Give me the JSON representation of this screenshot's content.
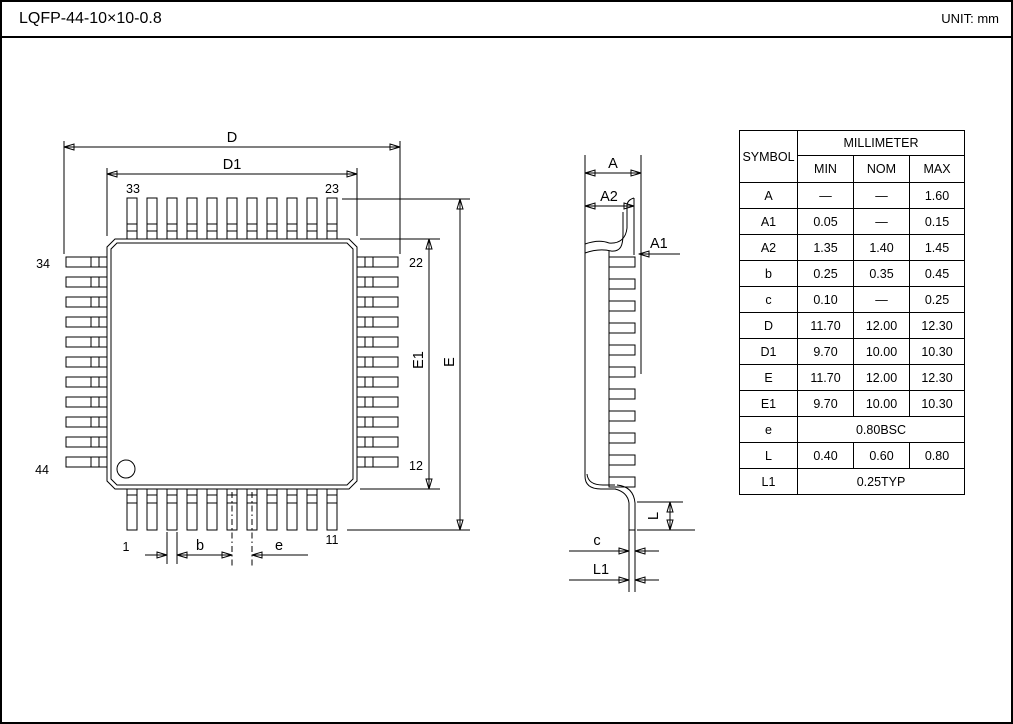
{
  "page": {
    "title": "LQFP-44-10×10-0.8",
    "unit_label": "UNIT: mm"
  },
  "top_view": {
    "dim_labels": {
      "D": "D",
      "D1": "D1",
      "E": "E",
      "E1": "E1",
      "b": "b",
      "e": "e"
    },
    "pin_numbers": {
      "p33": "33",
      "p23": "23",
      "p34": "34",
      "p44": "44",
      "p22": "22",
      "p12": "12",
      "p1": "1",
      "p11": "11"
    }
  },
  "side_view": {
    "dim_labels": {
      "A": "A",
      "A2": "A2",
      "A1": "A1",
      "L": "L",
      "c": "c",
      "L1": "L1"
    }
  },
  "table": {
    "symbol_header": "SYMBOL",
    "unit_header": "MILLIMETER",
    "min_header": "MIN",
    "nom_header": "NOM",
    "max_header": "MAX",
    "rows": [
      {
        "symbol": "A",
        "min": "—",
        "nom": "—",
        "max": "1.60"
      },
      {
        "symbol": "A1",
        "min": "0.05",
        "nom": "—",
        "max": "0.15"
      },
      {
        "symbol": "A2",
        "min": "1.35",
        "nom": "1.40",
        "max": "1.45"
      },
      {
        "symbol": "b",
        "min": "0.25",
        "nom": "0.35",
        "max": "0.45"
      },
      {
        "symbol": "c",
        "min": "0.10",
        "nom": "—",
        "max": "0.25"
      },
      {
        "symbol": "D",
        "min": "11.70",
        "nom": "12.00",
        "max": "12.30"
      },
      {
        "symbol": "D1",
        "min": "9.70",
        "nom": "10.00",
        "max": "10.30"
      },
      {
        "symbol": "E",
        "min": "11.70",
        "nom": "12.00",
        "max": "12.30"
      },
      {
        "symbol": "E1",
        "min": "9.70",
        "nom": "10.00",
        "max": "10.30"
      },
      {
        "symbol": "e",
        "span": "0.80BSC"
      },
      {
        "symbol": "L",
        "min": "0.40",
        "nom": "0.60",
        "max": "0.80"
      },
      {
        "symbol": "L1",
        "span": "0.25TYP"
      }
    ]
  }
}
